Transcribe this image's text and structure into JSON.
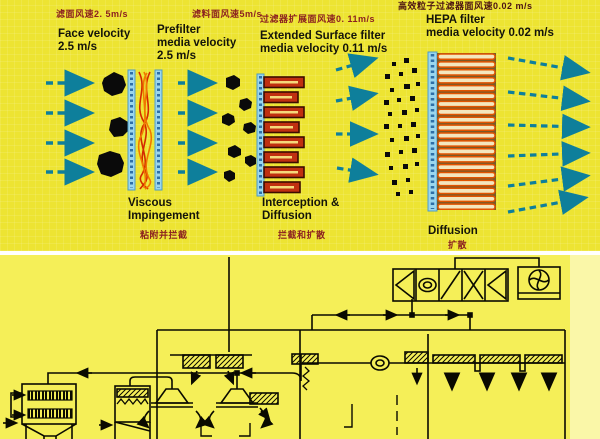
{
  "colors": {
    "top_background": "#EDE432",
    "bottom_background": "#F5EF58",
    "divider": "#FFFFFF",
    "arrow_teal": "#0E7F9B",
    "chinese_text": "#8B2020",
    "english_text": "#14140A",
    "schematic_line": "#0A0A00",
    "prefilter_fiber_red": "#D42A00",
    "prefilter_fiber_orange": "#F07800",
    "filter_frame_blue": "#9AD6EE",
    "pleat_dark_red": "#B32D10",
    "hepa_pleat_outline": "#E25400",
    "particle_black": "#0A0A0A"
  },
  "stages": [
    {
      "cn": "滤面风速2. 5m/s",
      "en": "Face velocity\n2.5 m/s"
    },
    {
      "cn": "滤料面风速5m/s",
      "en": "Prefilter\nmedia velocity\n2.5 m/s"
    },
    {
      "cn": "过滤器扩展面风速0. 11m/s",
      "en": "Extended Surface filter\nmedia velocity 0.11 m/s"
    },
    {
      "cn": "高效粒子过滤器面风速0.02 m/s",
      "en": "HEPA filter\nmedia velocity 0.02 m/s"
    }
  ],
  "mechanisms": [
    {
      "en": "Viscous\nImpingement",
      "cn": "粘附并拦截"
    },
    {
      "en": "Interception &\nDiffusion",
      "cn": "拦截和扩散"
    },
    {
      "en": "Diffusion",
      "cn": "扩散"
    }
  ],
  "schematic": {
    "parts": [
      "dust-collector",
      "return-duct",
      "supply-duct",
      "air-handling-unit",
      "return-fan",
      "media-filter-unit",
      "ceiling-filter-box",
      "supply-hood",
      "cleanroom-hepa-ceiling",
      "laminar-flow-arrows"
    ]
  }
}
